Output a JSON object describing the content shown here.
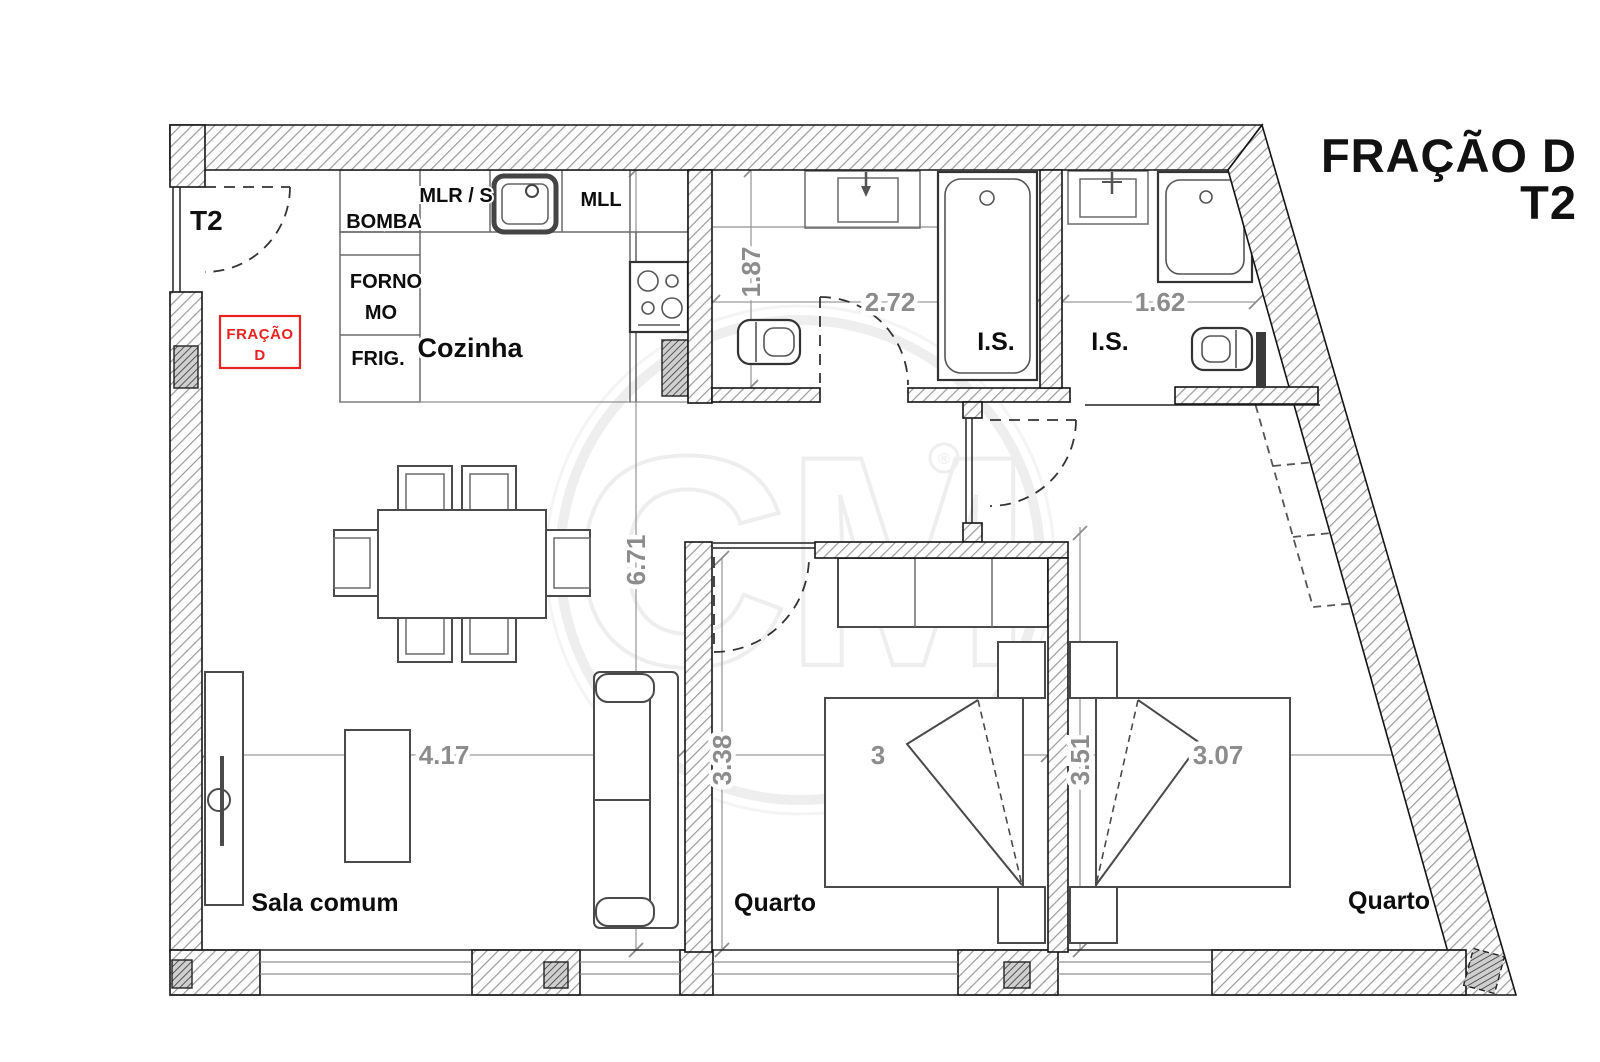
{
  "header": {
    "title_line1": "FRAÇÃO D",
    "title_line2": "T2"
  },
  "stamp": {
    "line1": "FRAÇÃO",
    "line2": "D"
  },
  "entry": {
    "label": "T2"
  },
  "rooms": {
    "kitchen": "Cozinha",
    "living_room": "Sala comum",
    "bedroom1": "Quarto",
    "bedroom2": "Quarto",
    "bathroom1": "I.S.",
    "bathroom2": "I.S."
  },
  "kitchen_items": {
    "bomba": "BOMBA",
    "mlr_s": "MLR / S",
    "mll": "MLL",
    "forno": "FORNO",
    "mo": "MO",
    "frig": "FRIG."
  },
  "dimensions": {
    "bathroom1_depth": "1.87",
    "bathroom1_width": "2.72",
    "bathroom2_width": "1.62",
    "living_height": "6.71",
    "living_width": "4.17",
    "bedroom1_height": "3.38",
    "bedroom1_width": "3",
    "bedroom2_height": "3.51",
    "bedroom2_width": "3.07"
  },
  "watermark": {
    "text": "CM",
    "registered": "®"
  },
  "colors": {
    "stamp_red": "#e62320",
    "dimension_gray": "#8c8c8c",
    "wall_line": "#141414",
    "hatch_gray": "#9b9b9b"
  }
}
